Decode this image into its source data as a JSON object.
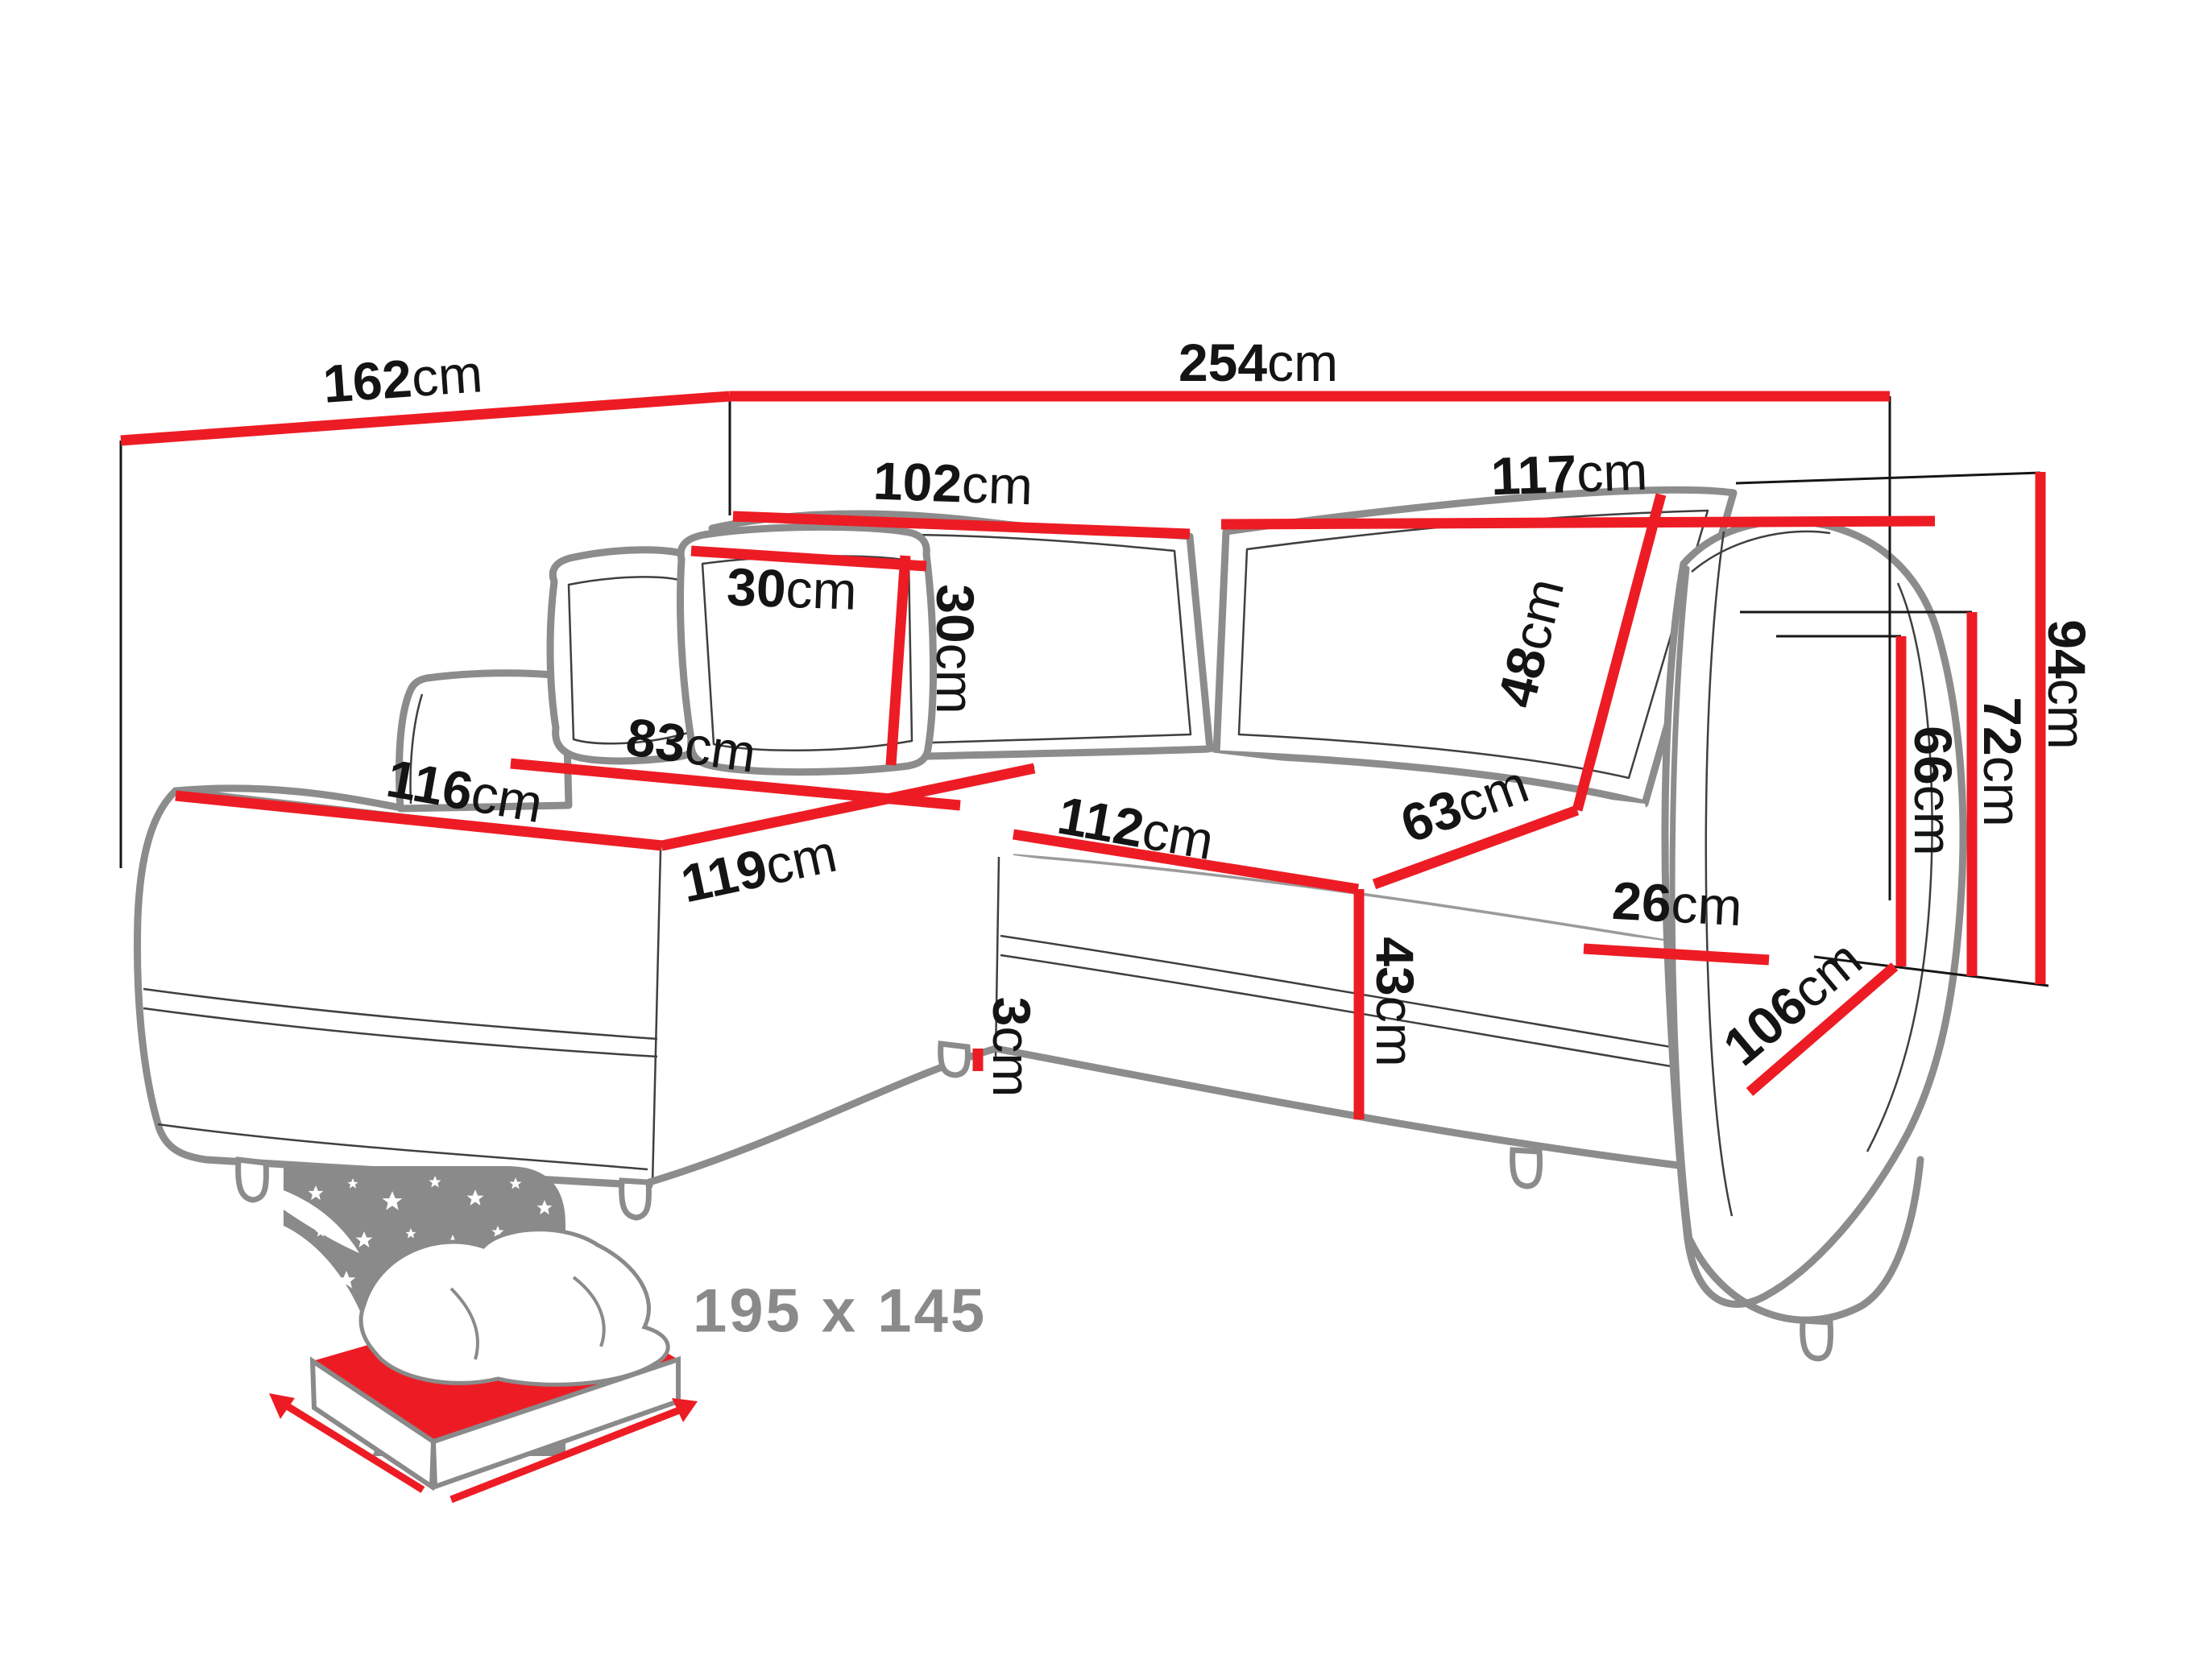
{
  "diagram": {
    "type": "corner-sofa-dimension-diagram",
    "dimensions": {
      "left_side_depth": {
        "value": "162",
        "unit": "cm"
      },
      "total_width": {
        "value": "254",
        "unit": "cm"
      },
      "backrest_left_width": {
        "value": "102",
        "unit": "cm"
      },
      "backrest_right_width": {
        "value": "117",
        "unit": "cm"
      },
      "pillow_width": {
        "value": "30",
        "unit": "cm"
      },
      "pillow_height": {
        "value": "30",
        "unit": "cm"
      },
      "backrest_cushion_height": {
        "value": "48",
        "unit": "cm"
      },
      "chaise_back_width": {
        "value": "83",
        "unit": "cm"
      },
      "chaise_width": {
        "value": "116",
        "unit": "cm"
      },
      "chaise_depth": {
        "value": "119",
        "unit": "cm"
      },
      "seat_front_width": {
        "value": "112",
        "unit": "cm"
      },
      "seat_depth": {
        "value": "63",
        "unit": "cm"
      },
      "armrest_width": {
        "value": "26",
        "unit": "cm"
      },
      "seat_height": {
        "value": "43",
        "unit": "cm"
      },
      "leg_height": {
        "value": "3",
        "unit": "cm"
      },
      "armrest_height": {
        "value": "66",
        "unit": "cm"
      },
      "backrest_height": {
        "value": "72",
        "unit": "cm"
      },
      "total_height": {
        "value": "94",
        "unit": "cm"
      },
      "armrest_depth": {
        "value": "106",
        "unit": "cm"
      }
    },
    "sleeping_area": {
      "label": "195 x 145"
    },
    "colors": {
      "dimension_red": "#ed1c24",
      "label_black": "#141414",
      "sofa_gray": "#8c8c8c",
      "inner_line": "#3f3f3f",
      "icon_gray": "#8a8a8a",
      "background": "#ffffff"
    }
  }
}
